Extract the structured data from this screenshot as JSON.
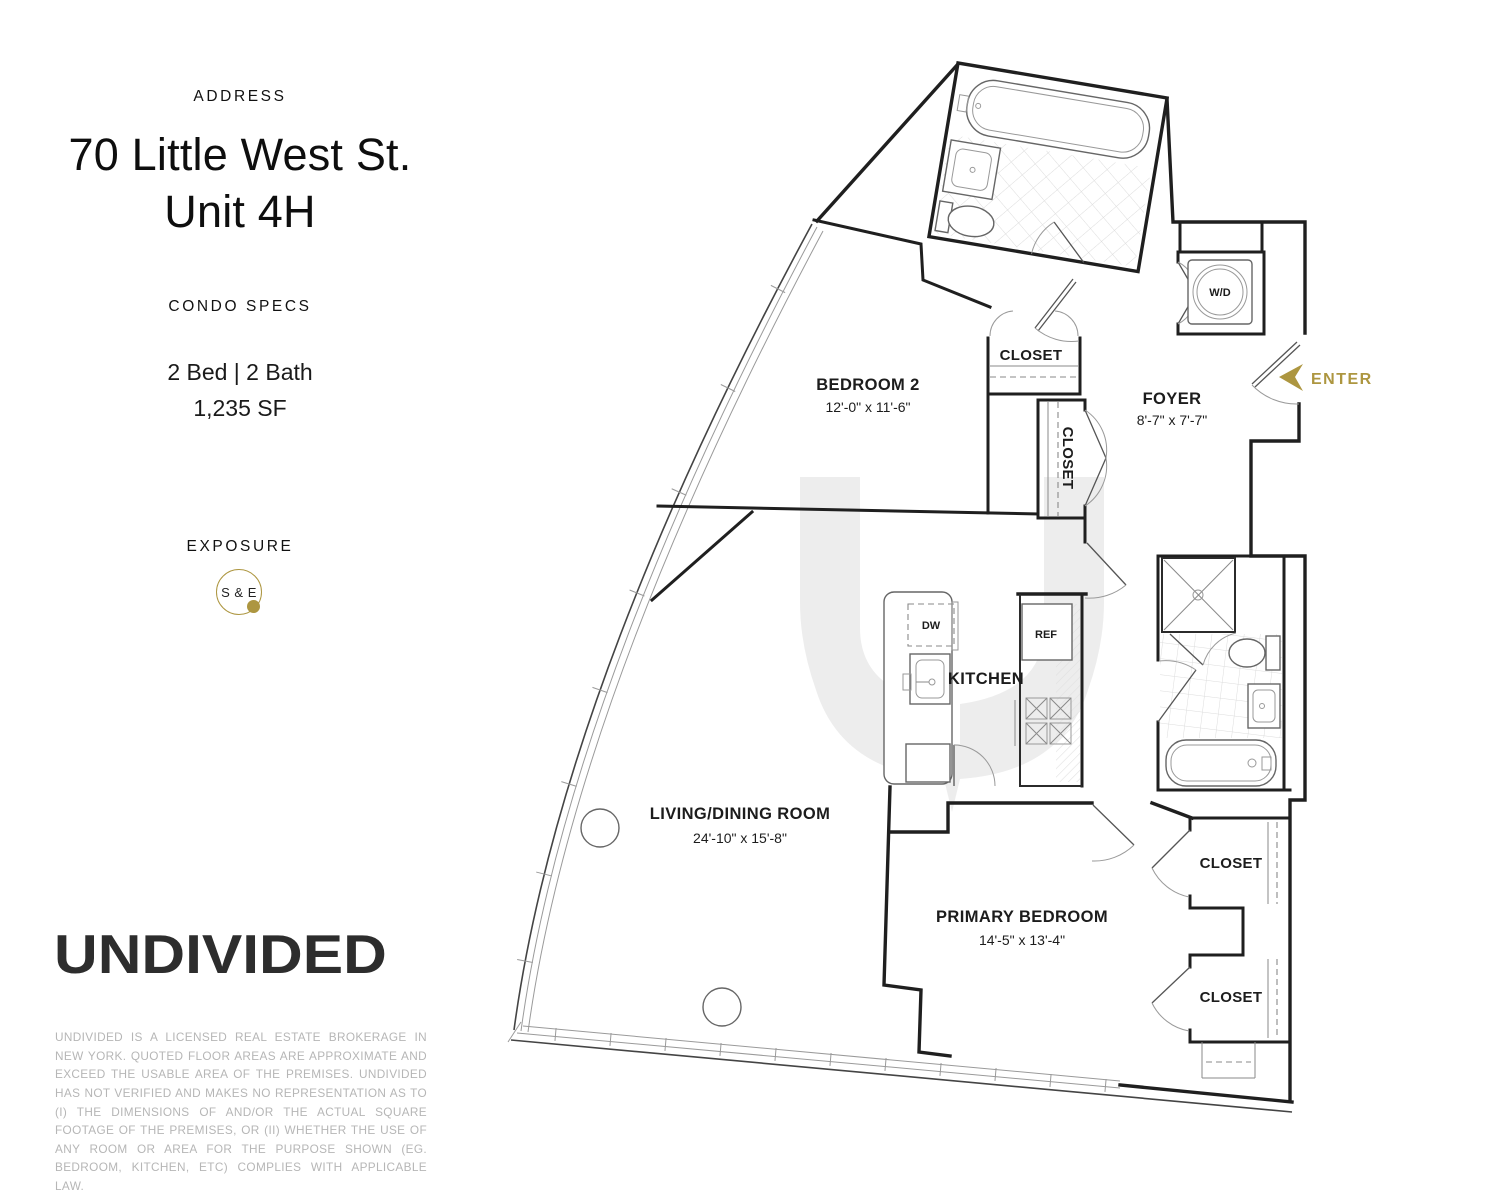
{
  "sidebar": {
    "address_label": "ADDRESS",
    "address_line1": "70 Little West St.",
    "address_line2": "Unit 4H",
    "specs_label": "CONDO SPECS",
    "specs_beds_baths": "2 Bed | 2 Bath",
    "specs_area": "1,235 SF",
    "exposure_label": "EXPOSURE",
    "exposure_value": "S & E",
    "brand": "UNDIVIDED",
    "disclaimer": "UNDIVIDED IS A LICENSED REAL ESTATE BROKERAGE IN NEW YORK. QUOTED FLOOR AREAS ARE APPROXIMATE AND EXCEED THE USABLE AREA OF THE PREMISES. UNDIVIDED HAS NOT VERIFIED AND MAKES NO REPRESENTATION AS TO (I) THE DIMENSIONS OF AND/OR THE ACTUAL SQUARE FOOTAGE OF THE PREMISES, OR (II) WHETHER THE USE OF ANY ROOM OR AREA FOR THE PURPOSE SHOWN (EG. BEDROOM, KITCHEN, ETC) COMPLIES WITH APPLICABLE LAW."
  },
  "floorplan": {
    "enter_label": "ENTER",
    "closet_label": "CLOSET",
    "rooms": {
      "bedroom2": {
        "name": "BEDROOM 2",
        "dims": "12'-0\" x 11'-6\""
      },
      "foyer": {
        "name": "FOYER",
        "dims": "8'-7\" x 7'-7\""
      },
      "kitchen": {
        "name": "KITCHEN"
      },
      "living": {
        "name": "LIVING/DINING ROOM",
        "dims": "24'-10\" x 15'-8\""
      },
      "primary": {
        "name": "PRIMARY BEDROOM",
        "dims": "14'-5\" x 13'-4\""
      }
    },
    "appliances": {
      "washer_dryer": "W/D",
      "dishwasher": "DW",
      "refrigerator": "REF"
    }
  },
  "colors": {
    "gold": "#AD9640",
    "wall": "#1f1f1f",
    "watermark": "#EDEDED",
    "tile": "#DCDCDC",
    "muted": "#B6B6B6"
  }
}
